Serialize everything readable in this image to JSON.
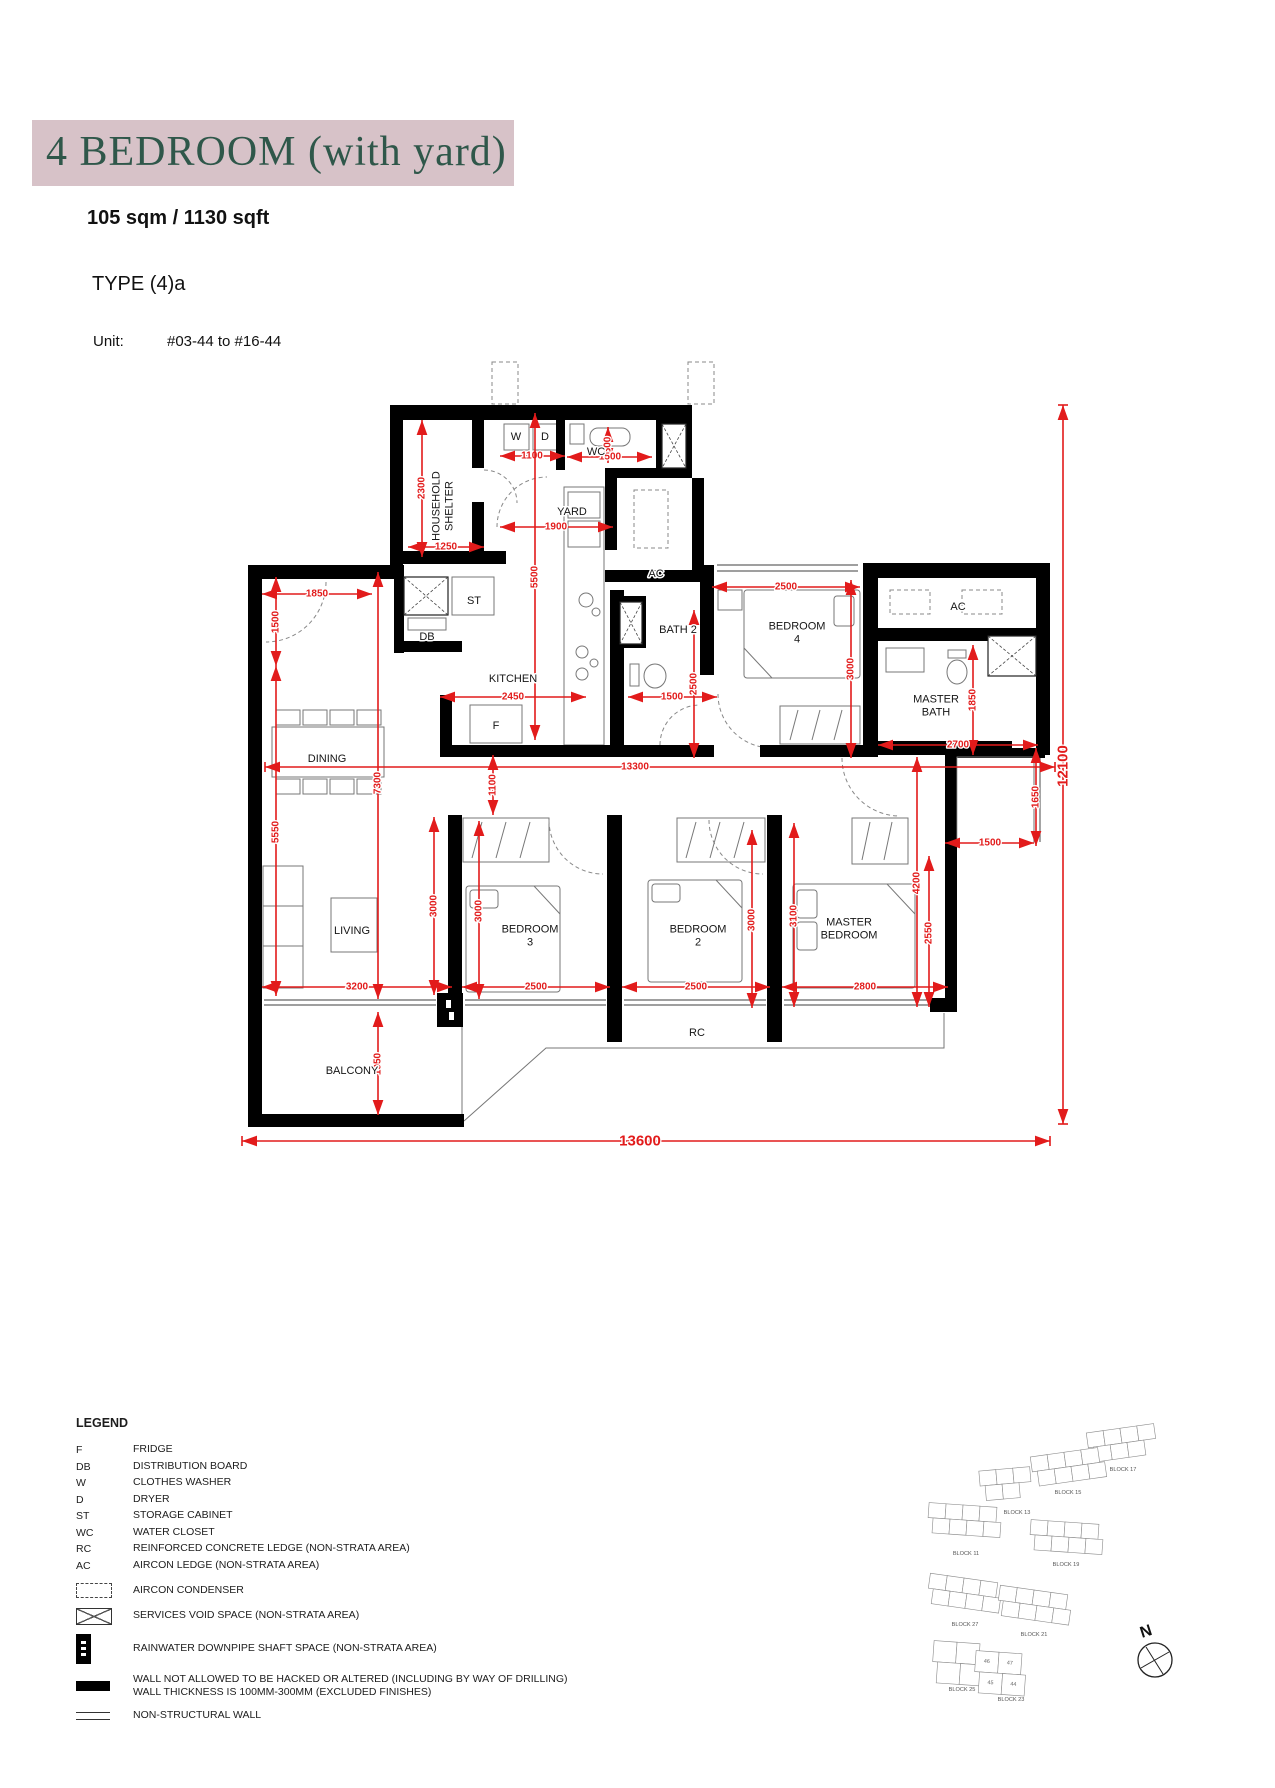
{
  "header": {
    "title": "4 BEDROOM (with yard)",
    "area": "105 sqm / 1130 sqft",
    "type": "TYPE (4)a",
    "unit_label": "Unit:",
    "unit_value": "#03-44 to #16-44"
  },
  "colors": {
    "banner_bg": "#d7c2c8",
    "title_green": "#2f574a",
    "dim_red": "#e21b1b",
    "highlight_pink": "#ee8d8d"
  },
  "floor_plan": {
    "room_labels": [
      {
        "lines": [
          "HOUSEHOLD",
          "SHELTER"
        ],
        "x": 443,
        "y": 506,
        "rot": -90
      },
      {
        "lines": [
          "YARD"
        ],
        "x": 572,
        "y": 512
      },
      {
        "lines": [
          "WC"
        ],
        "x": 596,
        "y": 452
      },
      {
        "lines": [
          "W"
        ],
        "x": 516,
        "y": 437,
        "size": 7
      },
      {
        "lines": [
          "D"
        ],
        "x": 545,
        "y": 437,
        "size": 7
      },
      {
        "lines": [
          "AC"
        ],
        "x": 656,
        "y": 574
      },
      {
        "lines": [
          "AC"
        ],
        "x": 958,
        "y": 607
      },
      {
        "lines": [
          "BATH 2"
        ],
        "x": 678,
        "y": 630
      },
      {
        "lines": [
          "BEDROOM",
          "4"
        ],
        "x": 797,
        "y": 633
      },
      {
        "lines": [
          "MASTER",
          "BATH"
        ],
        "x": 936,
        "y": 706
      },
      {
        "lines": [
          "KITCHEN"
        ],
        "x": 513,
        "y": 679
      },
      {
        "lines": [
          "ST"
        ],
        "x": 474,
        "y": 601,
        "size": 8
      },
      {
        "lines": [
          "DB"
        ],
        "x": 427,
        "y": 637,
        "size": 8
      },
      {
        "lines": [
          "F"
        ],
        "x": 496,
        "y": 726,
        "size": 8
      },
      {
        "lines": [
          "DINING"
        ],
        "x": 327,
        "y": 759
      },
      {
        "lines": [
          "LIVING"
        ],
        "x": 352,
        "y": 931
      },
      {
        "lines": [
          "BEDROOM",
          "3"
        ],
        "x": 530,
        "y": 936
      },
      {
        "lines": [
          "BEDROOM",
          "2"
        ],
        "x": 698,
        "y": 936
      },
      {
        "lines": [
          "MASTER",
          "BEDROOM"
        ],
        "x": 849,
        "y": 929
      },
      {
        "lines": [
          "BALCONY"
        ],
        "x": 352,
        "y": 1071
      },
      {
        "lines": [
          "RC"
        ],
        "x": 697,
        "y": 1033
      }
    ],
    "dimensions": [
      {
        "t": "2300",
        "x1": 422,
        "y1": 420,
        "x2": 422,
        "y2": 557,
        "lx": 422,
        "ly": 488,
        "v": 1
      },
      {
        "t": "1250",
        "x1": 408,
        "y1": 547,
        "x2": 484,
        "y2": 547,
        "lx": 446,
        "ly": 547
      },
      {
        "t": "1100",
        "x1": 500,
        "y1": 456,
        "x2": 565,
        "y2": 456,
        "lx": 532,
        "ly": 456
      },
      {
        "t": "600",
        "x1": 608,
        "y1": 427,
        "x2": 608,
        "y2": 463,
        "lx": 608,
        "ly": 445,
        "v": 1
      },
      {
        "t": "1500",
        "x1": 567,
        "y1": 457,
        "x2": 652,
        "y2": 457,
        "lx": 610,
        "ly": 457
      },
      {
        "t": "1900",
        "x1": 500,
        "y1": 527,
        "x2": 613,
        "y2": 527,
        "lx": 556,
        "ly": 527
      },
      {
        "t": "5500",
        "x1": 535,
        "y1": 413,
        "x2": 535,
        "y2": 740,
        "lx": 535,
        "ly": 577,
        "v": 1
      },
      {
        "t": "1850",
        "x1": 262,
        "y1": 594,
        "x2": 372,
        "y2": 594,
        "lx": 317,
        "ly": 594
      },
      {
        "t": "1500",
        "x1": 276,
        "y1": 577,
        "x2": 276,
        "y2": 666,
        "lx": 276,
        "ly": 622,
        "v": 1
      },
      {
        "t": "2450",
        "x1": 440,
        "y1": 697,
        "x2": 586,
        "y2": 697,
        "lx": 513,
        "ly": 697
      },
      {
        "t": "1500",
        "x1": 628,
        "y1": 697,
        "x2": 717,
        "y2": 697,
        "lx": 672,
        "ly": 697
      },
      {
        "t": "2500",
        "x1": 694,
        "y1": 610,
        "x2": 694,
        "y2": 758,
        "lx": 694,
        "ly": 684,
        "v": 1
      },
      {
        "t": "2500",
        "x1": 712,
        "y1": 587,
        "x2": 860,
        "y2": 587,
        "lx": 786,
        "ly": 587
      },
      {
        "t": "3000",
        "x1": 851,
        "y1": 580,
        "x2": 851,
        "y2": 758,
        "lx": 851,
        "ly": 669,
        "v": 1
      },
      {
        "t": "1850",
        "x1": 973,
        "y1": 645,
        "x2": 973,
        "y2": 755,
        "lx": 973,
        "ly": 700,
        "v": 1
      },
      {
        "t": "2700",
        "x1": 878,
        "y1": 745,
        "x2": 1038,
        "y2": 745,
        "lx": 958,
        "ly": 745
      },
      {
        "t": "1650",
        "x1": 1036,
        "y1": 748,
        "x2": 1036,
        "y2": 846,
        "lx": 1036,
        "ly": 797,
        "v": 1
      },
      {
        "t": "1500",
        "x1": 945,
        "y1": 843,
        "x2": 1034,
        "y2": 843,
        "lx": 990,
        "ly": 843
      },
      {
        "t": "13300",
        "x1": 265,
        "y1": 767,
        "x2": 1055,
        "y2": 767,
        "lx": 635,
        "ly": 767,
        "ticks": 1
      },
      {
        "t": "7300",
        "x1": 378,
        "y1": 572,
        "x2": 378,
        "y2": 999,
        "lx": 378,
        "ly": 783,
        "v": 1
      },
      {
        "t": "1100",
        "x1": 493,
        "y1": 755,
        "x2": 493,
        "y2": 815,
        "lx": 493,
        "ly": 785,
        "v": 1
      },
      {
        "t": "5550",
        "x1": 276,
        "y1": 666,
        "x2": 276,
        "y2": 996,
        "lx": 276,
        "ly": 832,
        "v": 1
      },
      {
        "t": "3000",
        "x1": 434,
        "y1": 817,
        "x2": 434,
        "y2": 995,
        "lx": 434,
        "ly": 906,
        "v": 1
      },
      {
        "t": "3000",
        "x1": 479,
        "y1": 821,
        "x2": 479,
        "y2": 999,
        "lx": 479,
        "ly": 911,
        "v": 1
      },
      {
        "t": "3200",
        "x1": 262,
        "y1": 987,
        "x2": 452,
        "y2": 987,
        "lx": 357,
        "ly": 987
      },
      {
        "t": "2500",
        "x1": 462,
        "y1": 987,
        "x2": 610,
        "y2": 987,
        "lx": 536,
        "ly": 987
      },
      {
        "t": "3000",
        "x1": 752,
        "y1": 830,
        "x2": 752,
        "y2": 1008,
        "lx": 752,
        "ly": 920,
        "v": 1
      },
      {
        "t": "2500",
        "x1": 622,
        "y1": 987,
        "x2": 770,
        "y2": 987,
        "lx": 696,
        "ly": 987
      },
      {
        "t": "3100",
        "x1": 794,
        "y1": 823,
        "x2": 794,
        "y2": 1007,
        "lx": 794,
        "ly": 916,
        "v": 1
      },
      {
        "t": "2800",
        "x1": 782,
        "y1": 987,
        "x2": 948,
        "y2": 987,
        "lx": 865,
        "ly": 987
      },
      {
        "t": "4200",
        "x1": 917,
        "y1": 757,
        "x2": 917,
        "y2": 1007,
        "lx": 917,
        "ly": 883,
        "v": 1
      },
      {
        "t": "2550",
        "x1": 929,
        "y1": 856,
        "x2": 929,
        "y2": 1007,
        "lx": 929,
        "ly": 933,
        "v": 1
      },
      {
        "t": "1950",
        "x1": 378,
        "y1": 1012,
        "x2": 378,
        "y2": 1115,
        "lx": 378,
        "ly": 1064,
        "v": 1
      },
      {
        "t": "13600",
        "x1": 242,
        "y1": 1141,
        "x2": 1050,
        "y2": 1141,
        "lx": 640,
        "ly": 1141,
        "size": 15,
        "ticks": 1
      },
      {
        "t": "12100",
        "x1": 1063,
        "y1": 405,
        "x2": 1063,
        "y2": 1124,
        "lx": 1063,
        "ly": 766,
        "v": 1,
        "size": 15,
        "ticks": 1
      }
    ]
  },
  "legend": {
    "title": "LEGEND",
    "items": [
      {
        "sym": "F",
        "label": "FRIDGE"
      },
      {
        "sym": "DB",
        "label": "DISTRIBUTION BOARD"
      },
      {
        "sym": "W",
        "label": "CLOTHES WASHER"
      },
      {
        "sym": "D",
        "label": "DRYER"
      },
      {
        "sym": "ST",
        "label": "STORAGE CABINET"
      },
      {
        "sym": "WC",
        "label": "WATER CLOSET"
      },
      {
        "sym": "RC",
        "label": "REINFORCED CONCRETE LEDGE (NON-STRATA AREA)"
      },
      {
        "sym": "AC",
        "label": "AIRCON LEDGE (NON-STRATA AREA)"
      },
      {
        "icon": "aircon-condenser",
        "label": "AIRCON CONDENSER"
      },
      {
        "icon": "services-void",
        "label": "SERVICES VOID SPACE (NON-STRATA AREA)"
      },
      {
        "icon": "rainwater-shaft",
        "label": "RAINWATER DOWNPIPE SHAFT SPACE (NON-STRATA AREA)"
      },
      {
        "icon": "no-hack-wall",
        "label": "WALL NOT ALLOWED TO BE HACKED OR ALTERED (INCLUDING BY WAY OF DRILLING)",
        "label2": "WALL THICKNESS IS 100MM-300MM (EXCLUDED FINISHES)"
      },
      {
        "icon": "non-structural-wall",
        "label": "NON-STRUCTURAL WALL"
      }
    ]
  },
  "site_plan": {
    "north_label": "N",
    "blocks": [
      {
        "label": "BLOCK 17",
        "x": 1088,
        "y": 1428,
        "rows": [
          4,
          3
        ],
        "rot": -8,
        "lx": 1123,
        "ly": 1471
      },
      {
        "label": "BLOCK 15",
        "x": 1032,
        "y": 1452,
        "rows": [
          4,
          4
        ],
        "rot": -8,
        "lx": 1068,
        "ly": 1494
      },
      {
        "label": "BLOCK 13",
        "x": 980,
        "y": 1468,
        "rows": [
          3,
          2
        ],
        "rot": -5,
        "lx": 1017,
        "ly": 1514
      },
      {
        "label": "BLOCK 11",
        "x": 928,
        "y": 1505,
        "rows": [
          4,
          4
        ],
        "rot": 4,
        "lx": 966,
        "ly": 1555
      },
      {
        "label": "BLOCK 19",
        "x": 1030,
        "y": 1522,
        "rows": [
          4,
          4
        ],
        "rot": 4,
        "lx": 1066,
        "ly": 1566
      },
      {
        "label": "BLOCK 27",
        "x": 928,
        "y": 1578,
        "rows": [
          4,
          4
        ],
        "rot": 8,
        "lx": 965,
        "ly": 1626
      },
      {
        "label": "BLOCK 21",
        "x": 998,
        "y": 1590,
        "rows": [
          4,
          4
        ],
        "rot": 8,
        "lx": 1034,
        "ly": 1636
      },
      {
        "label": "BLOCK 25",
        "x": 933,
        "y": 1643,
        "rows": [
          2,
          2
        ],
        "rot": 4,
        "lx": 962,
        "ly": 1691,
        "big": 1
      },
      {
        "label": "BLOCK 23",
        "x": 975,
        "y": 1653,
        "rows": [
          2,
          2
        ],
        "rot": 4,
        "lx": 1011,
        "ly": 1701,
        "big": 1,
        "units": [
          [
            "46",
            "47"
          ],
          [
            "45",
            "44"
          ]
        ],
        "highlight": "44"
      }
    ],
    "compass": {
      "cx": 1155,
      "cy": 1660,
      "r": 17
    }
  }
}
